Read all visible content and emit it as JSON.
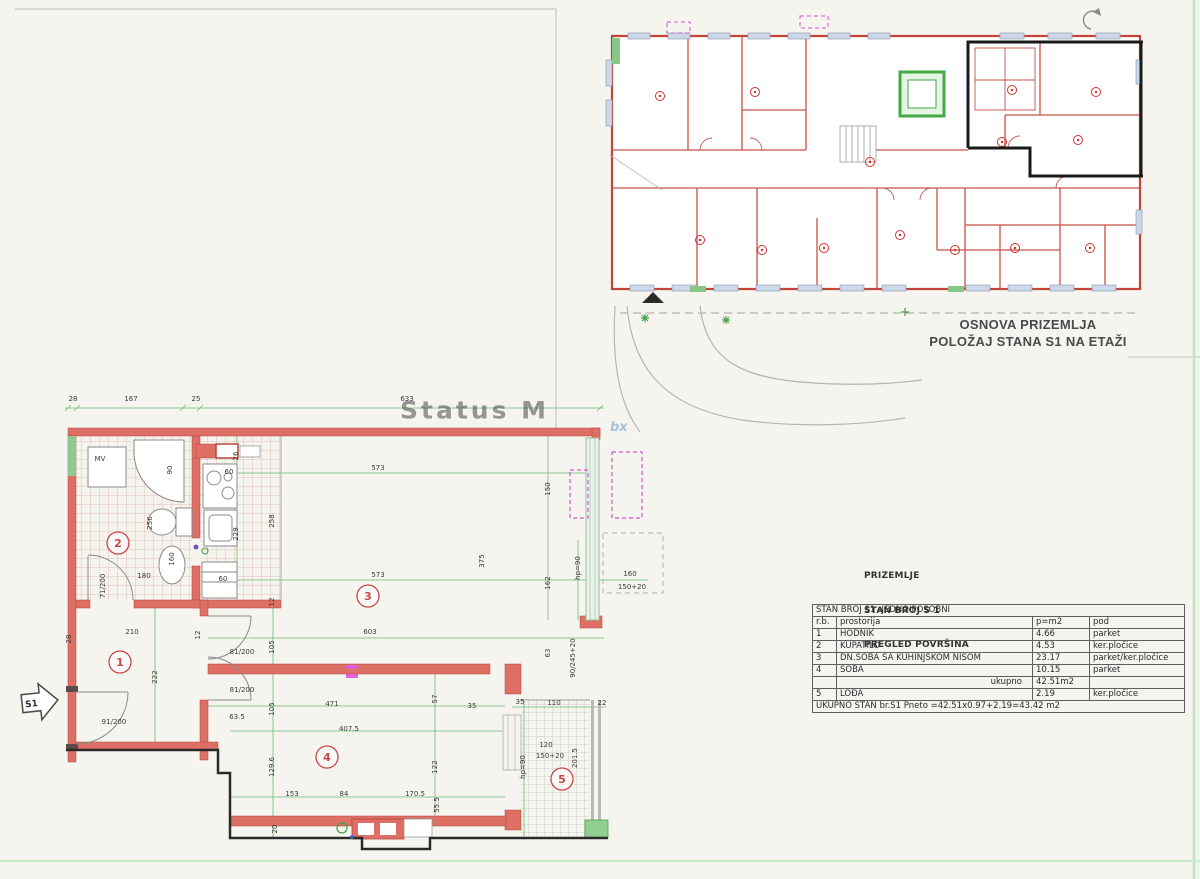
{
  "page": {
    "background": "#f5f4ef"
  },
  "colors": {
    "wall": "#dd6f64",
    "wall_edge": "#b5463e",
    "dimension_green": "#58ae5e",
    "s1_outline_black": "#1a1a1a",
    "badge_red": "#c84848",
    "site_gray": "#b6b6b0",
    "green_accent": "#86c686",
    "magenta": "#d455d4",
    "window_blue": "#ccd8e8"
  },
  "overview": {
    "title_line1": "OSNOVA PRIZEMLJA",
    "title_line2": "POLOŽAJ STANA S1 NA ETAŽI"
  },
  "watermark": {
    "text": "Status M",
    "text2": "bx"
  },
  "summary": {
    "heading": [
      "PRIZEMLJE",
      "STAN BROJ S 1",
      "PREGLED POVRŠINA"
    ],
    "table": {
      "title": "STAN BROJ S1 -JEDNOIPOSOBNI",
      "columns": [
        "r.b.",
        "prostorija",
        "p=m2",
        "pod"
      ],
      "rows": [
        {
          "rb": "1",
          "prostorija": "HODNIK",
          "p": "4.66",
          "pod": "parket"
        },
        {
          "rb": "2",
          "prostorija": "KUPATILO",
          "p": "4.53",
          "pod": "ker.pločice"
        },
        {
          "rb": "3",
          "prostorija": "DN.SOBA SA KUHINJSKOM NIŠOM",
          "p": "23.17",
          "pod": "parket/ker.pločice"
        },
        {
          "rb": "4",
          "prostorija": "SOBA",
          "p": "10.15",
          "pod": "parket"
        }
      ],
      "subtotal": {
        "label": "ukupno",
        "value": "42.51m2"
      },
      "extra_row": {
        "rb": "5",
        "prostorija": "LOĐA",
        "p": "2.19",
        "pod": "ker.pločice"
      },
      "footer": "UKUPNO STAN br.S1 Pneto =42.51x0.97+2.19=43.42 m2"
    }
  },
  "plan": {
    "entrance_label": "S1",
    "rooms": [
      {
        "num": "1",
        "x": 120,
        "y": 662
      },
      {
        "num": "2",
        "x": 118,
        "y": 543
      },
      {
        "num": "3",
        "x": 368,
        "y": 596
      },
      {
        "num": "4",
        "x": 327,
        "y": 757
      },
      {
        "num": "5",
        "x": 562,
        "y": 779
      }
    ],
    "labels": [
      {
        "t": "28",
        "x": 73,
        "y": 401
      },
      {
        "t": "167",
        "x": 131,
        "y": 401
      },
      {
        "t": "25",
        "x": 196,
        "y": 401
      },
      {
        "t": "633",
        "x": 407,
        "y": 401
      },
      {
        "t": "573",
        "x": 378,
        "y": 470
      },
      {
        "t": "150",
        "x": 550,
        "y": 489,
        "r": 1
      },
      {
        "t": "26",
        "x": 238,
        "y": 456,
        "r": 1
      },
      {
        "t": "229",
        "x": 238,
        "y": 534,
        "r": 1
      },
      {
        "t": "258",
        "x": 274,
        "y": 521,
        "r": 1
      },
      {
        "t": "375",
        "x": 484,
        "y": 561,
        "r": 1
      },
      {
        "t": "573",
        "x": 378,
        "y": 577
      },
      {
        "t": "162",
        "x": 550,
        "y": 583,
        "r": 1
      },
      {
        "t": "hp=90",
        "x": 580,
        "y": 568,
        "r": 1
      },
      {
        "t": "160",
        "x": 630,
        "y": 576
      },
      {
        "t": "150+20",
        "x": 632,
        "y": 589
      },
      {
        "t": "12",
        "x": 274,
        "y": 602,
        "r": 1
      },
      {
        "t": "603",
        "x": 370,
        "y": 634
      },
      {
        "t": "63",
        "x": 550,
        "y": 653,
        "r": 1
      },
      {
        "t": "90/245+20",
        "x": 575,
        "y": 658,
        "r": 1
      },
      {
        "t": "90",
        "x": 172,
        "y": 470,
        "r": 1
      },
      {
        "t": "MV",
        "x": 100,
        "y": 461
      },
      {
        "t": "60",
        "x": 229,
        "y": 474
      },
      {
        "t": "256",
        "x": 152,
        "y": 523,
        "r": 1
      },
      {
        "t": "160",
        "x": 174,
        "y": 559,
        "r": 1
      },
      {
        "t": "60",
        "x": 223,
        "y": 581
      },
      {
        "t": "180",
        "x": 144,
        "y": 578
      },
      {
        "t": "71/200",
        "x": 105,
        "y": 586,
        "r": 1
      },
      {
        "t": "28",
        "x": 71,
        "y": 639,
        "r": 1
      },
      {
        "t": "210",
        "x": 132,
        "y": 634
      },
      {
        "t": "12",
        "x": 200,
        "y": 635,
        "r": 1
      },
      {
        "t": "222",
        "x": 157,
        "y": 677,
        "r": 1
      },
      {
        "t": "91/200",
        "x": 114,
        "y": 724
      },
      {
        "t": "81/200",
        "x": 242,
        "y": 654
      },
      {
        "t": "81/200",
        "x": 242,
        "y": 692
      },
      {
        "t": "63.5",
        "x": 237,
        "y": 719
      },
      {
        "t": "105",
        "x": 274,
        "y": 647,
        "r": 1
      },
      {
        "t": "105",
        "x": 274,
        "y": 709,
        "r": 1
      },
      {
        "t": "129.6",
        "x": 274,
        "y": 767,
        "r": 1
      },
      {
        "t": "20",
        "x": 277,
        "y": 829,
        "r": 1
      },
      {
        "t": "471",
        "x": 332,
        "y": 706
      },
      {
        "t": "407.5",
        "x": 349,
        "y": 731
      },
      {
        "t": "57",
        "x": 437,
        "y": 699,
        "r": 1
      },
      {
        "t": "122",
        "x": 437,
        "y": 767,
        "r": 1
      },
      {
        "t": "55.5",
        "x": 439,
        "y": 805,
        "r": 1
      },
      {
        "t": "153",
        "x": 292,
        "y": 796
      },
      {
        "t": "84",
        "x": 344,
        "y": 796
      },
      {
        "t": "170.5",
        "x": 415,
        "y": 796
      },
      {
        "t": "35",
        "x": 472,
        "y": 708
      },
      {
        "t": "35",
        "x": 520,
        "y": 704
      },
      {
        "t": "110",
        "x": 554,
        "y": 705
      },
      {
        "t": "22",
        "x": 602,
        "y": 705
      },
      {
        "t": "120",
        "x": 546,
        "y": 747
      },
      {
        "t": "150+20",
        "x": 550,
        "y": 758
      },
      {
        "t": "201.5",
        "x": 577,
        "y": 758,
        "r": 1
      },
      {
        "t": "hp=90",
        "x": 525,
        "y": 767,
        "r": 1
      }
    ]
  }
}
